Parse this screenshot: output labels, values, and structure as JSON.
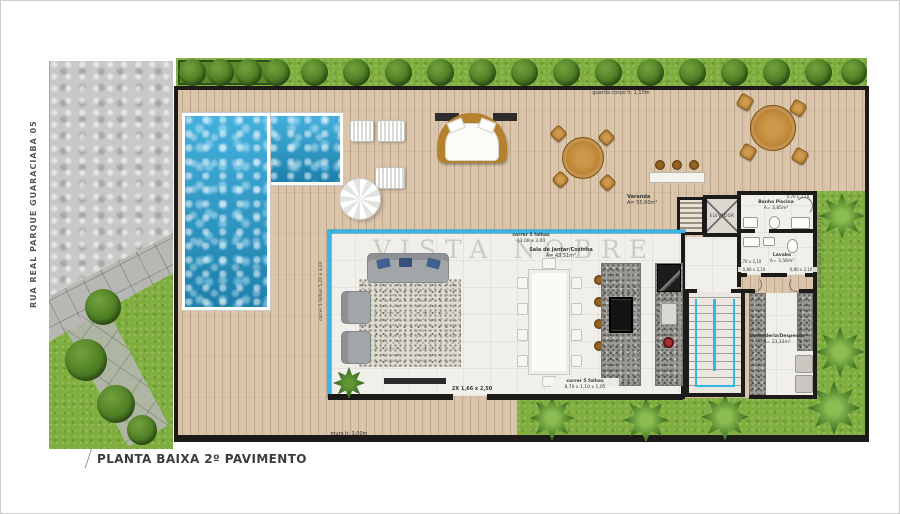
{
  "title": "PLANTA BAIXA 2º PAVIMENTO",
  "street": "RUA REAL PARQUE GUARACIABA 05",
  "watermark": "VISTA NOBRE",
  "notes": {
    "guard_rail": "guarda corpo h: 1,10m",
    "wall_height": "muro h: 3,00m"
  },
  "rooms": {
    "varanda": {
      "name": "Varanda",
      "area": "A= 55,60m²"
    },
    "sala_jantar_cozinha": {
      "name": "Sala de Jantar/Cozinha",
      "area": "A= 43,51m²"
    },
    "banho_piscina": {
      "name": "Banho Piscina",
      "area": "A= 3,85m²"
    },
    "lavabo": {
      "name": "Lavabo",
      "area": "A= 3,56m²"
    },
    "lavanderia": {
      "name": "Lavanderia/Despensa",
      "area": "A= 13,33m²"
    },
    "elevador": {
      "name": "ELEVADOR"
    }
  },
  "openings": {
    "glass_top": {
      "l1": "correr 5 folhas",
      "l2": "13,00 x 3,00"
    },
    "glass_left": {
      "l1": "correr 5 folhas",
      "l2": "5,20 x 3,00"
    },
    "glass_bottom": {
      "l1": "correr 5 folhas",
      "l2": "8,70 x 1,10 x 1,05"
    },
    "door_living": "2X 1,66 x 2,50",
    "door_banho": "0,70 x 2,10",
    "door_lavabo": "0,70 x 2,10",
    "door_hall_1": "0,80 x 2,10",
    "door_hall_2": "0,80 x 2,10",
    "window_lavanderia": {
      "l1": "correr 2 folhas",
      "l2": "1,60 x 1,10"
    },
    "window_east": {
      "l1": "janela basculante",
      "l2": "1,20 x 0,60 x 1,60"
    }
  },
  "colors": {
    "deck": "#d9c4aa",
    "pool": "#2a97c6",
    "grass": "#7fae3e",
    "glass_wall": "#38b6e6",
    "structural_wall": "#1d1b19",
    "granite": "#9a9892"
  }
}
